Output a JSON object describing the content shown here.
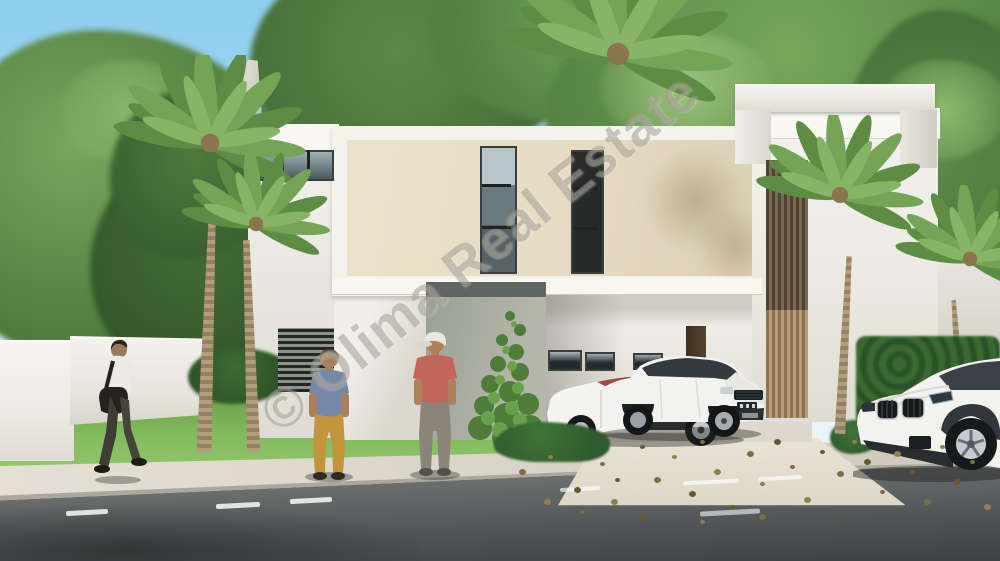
{
  "watermark": {
    "text": "© Olima Real Estate"
  },
  "palette": {
    "sky": "#9ed4ef",
    "foliage_dark": "#3f6632",
    "foliage_mid": "#5c8a47",
    "foliage_light": "#8cba6e",
    "facade_white": "#f3f2ed",
    "facade_beige": "#e8ddc4",
    "wall_gray": "#a3a79c",
    "wood_louver": "#b39a74",
    "grass": "#7cb65b",
    "hedge": "#33552a",
    "road_asphalt": "#55585a",
    "sidewalk": "#ded9cc",
    "car_white": "#f2f2ef",
    "shirt_blue": "#7688a8",
    "pants_mustard": "#c2943c",
    "shirt_coral": "#c4655c"
  },
  "objects": {
    "building": "modern two-story white and beige villa with carport and rooftop pergola",
    "vehicles": [
      "white convertible sedan parked in carport",
      "white SUV parked in carport",
      "white SUV parked on street at right"
    ],
    "people": [
      "man walking with shoulder bag talking on phone",
      "man standing in blue shirt and mustard pants",
      "man standing in coral shirt and white cap"
    ],
    "vegetation": [
      "palm trees",
      "tropical trees",
      "lawn",
      "hedges",
      "climbing ivy"
    ],
    "road_markings": "white dashed lane lines"
  }
}
